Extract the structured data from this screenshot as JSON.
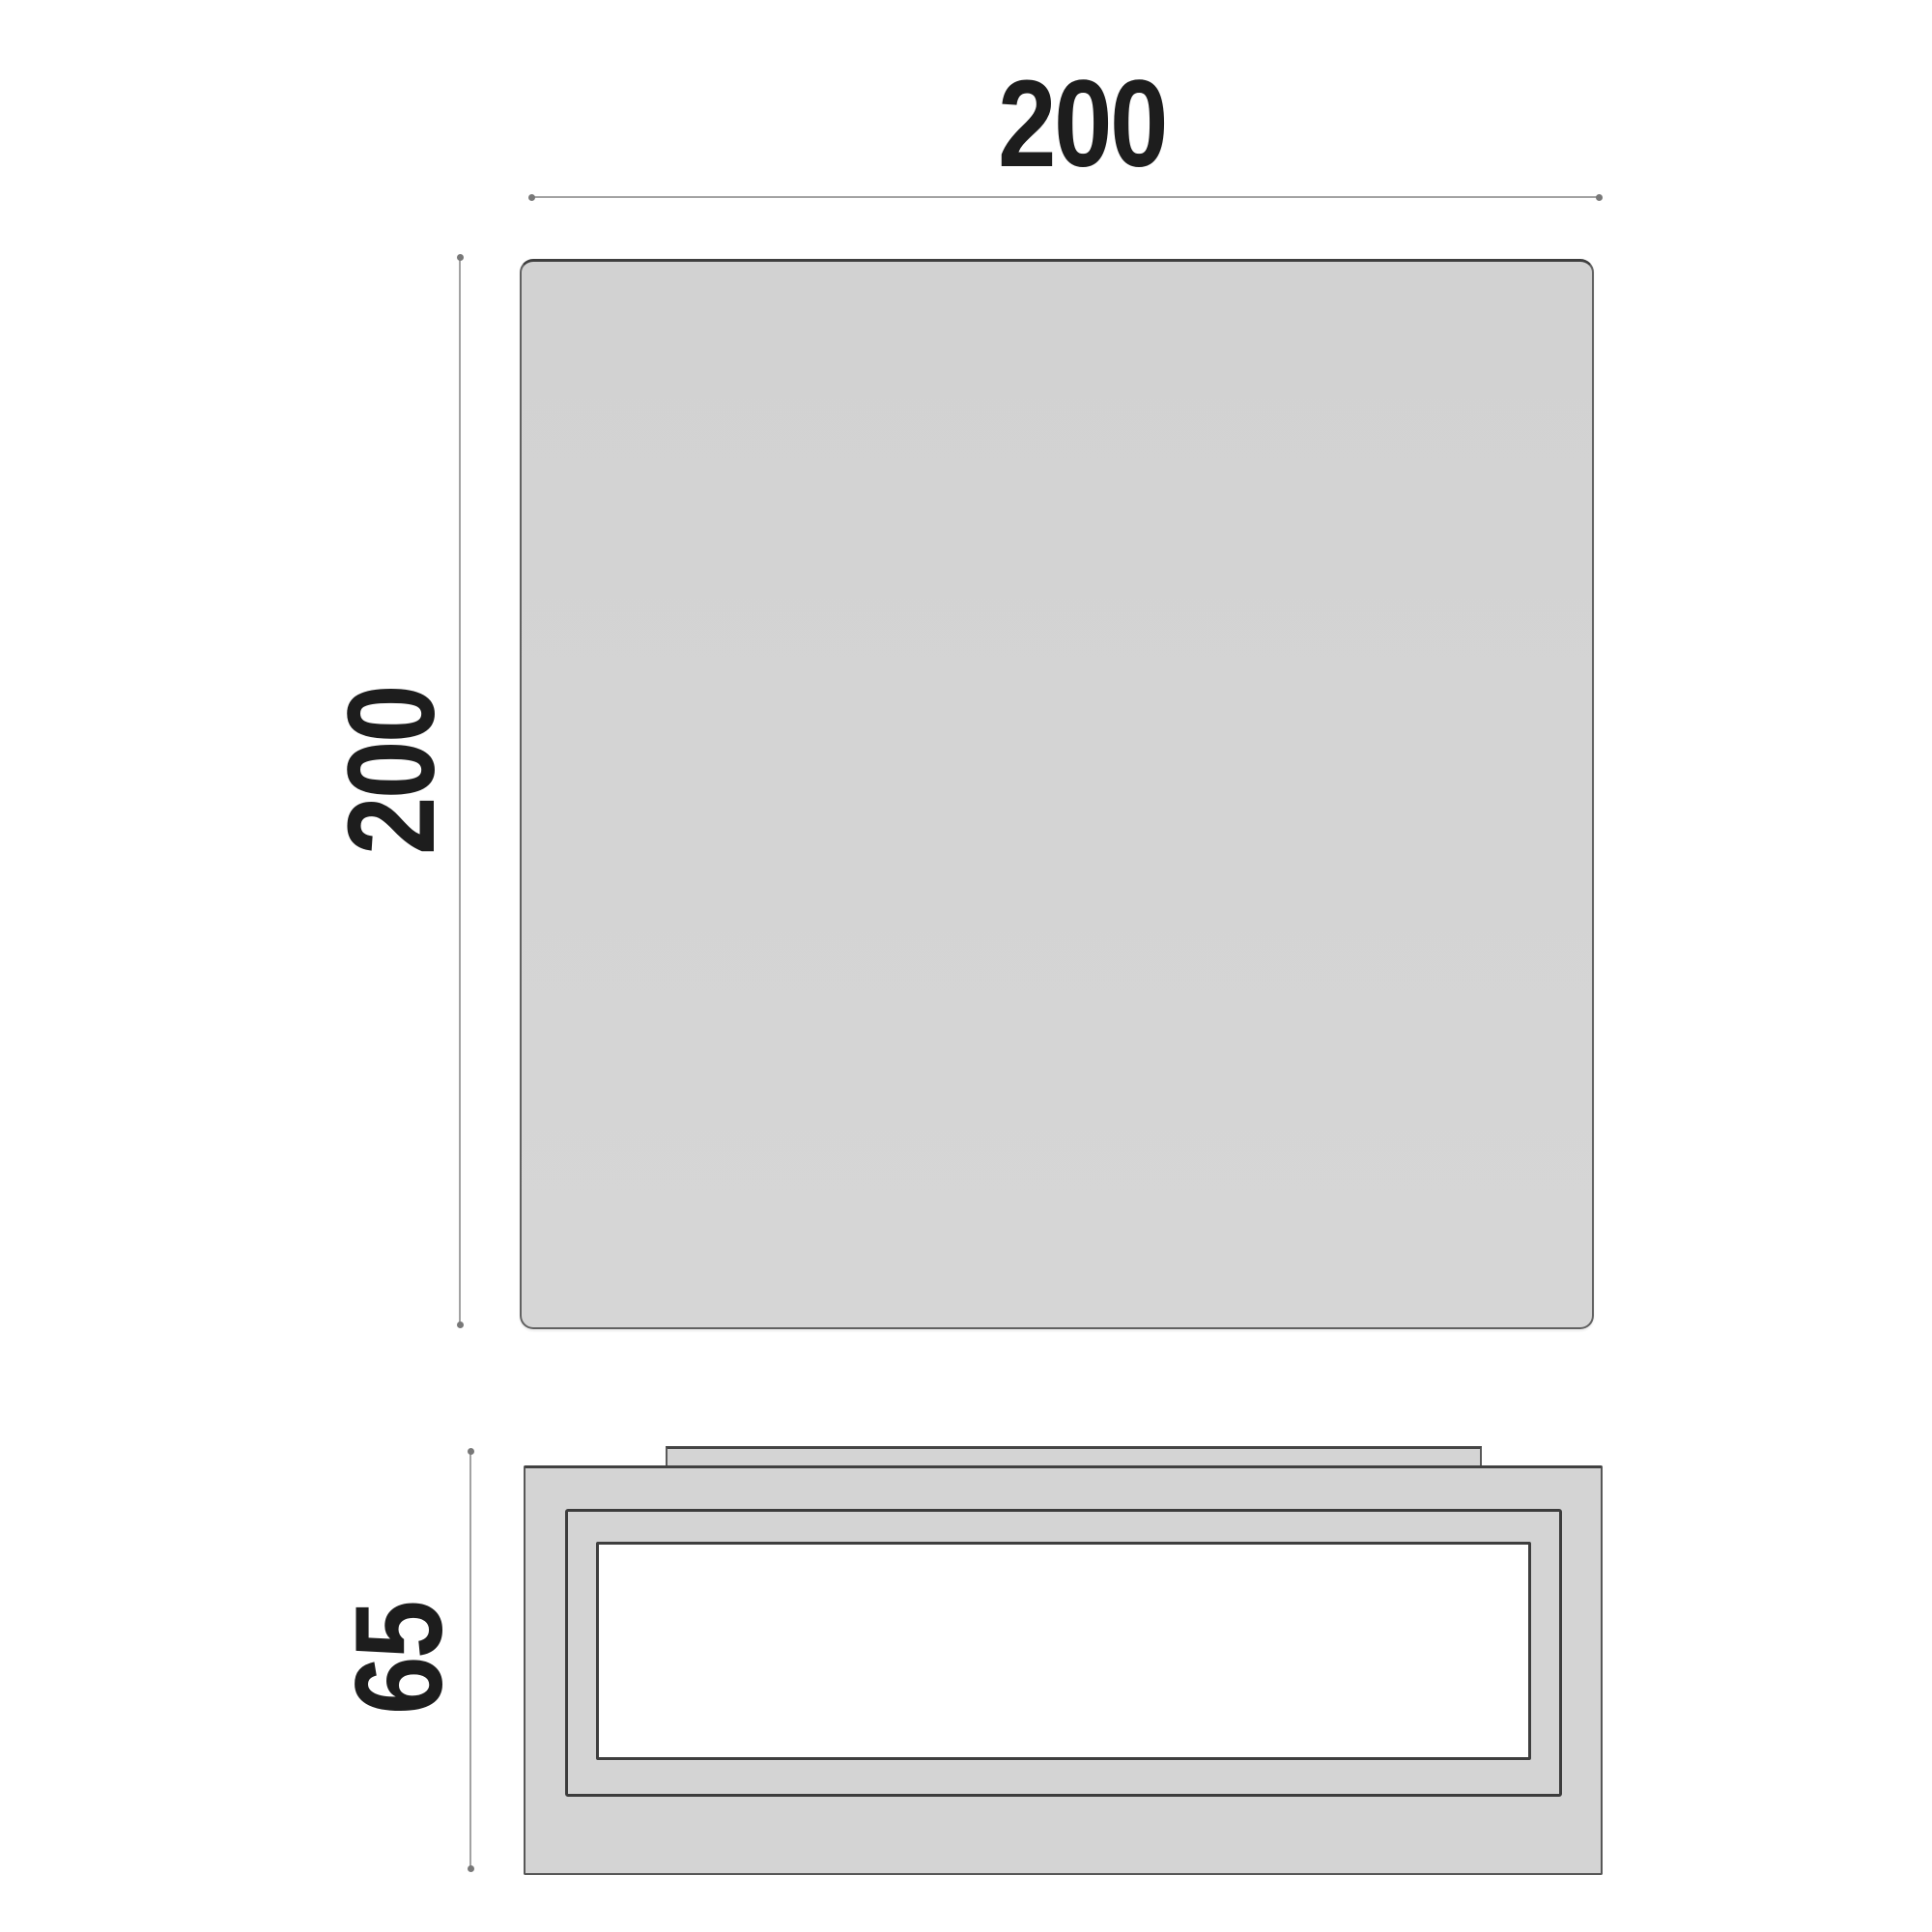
{
  "drawing": {
    "dimensions": {
      "width": {
        "value": "200"
      },
      "height": {
        "value": "200"
      },
      "depth": {
        "value": "65"
      }
    },
    "colors": {
      "background": "#ffffff",
      "panel_fill": "#d4d4d4",
      "panel_outline": "#5e5e5e",
      "frame_outline": "#3c3c3c",
      "diffuser_fill": "#ffffff",
      "dimension_line": "#a2a2a2",
      "dimension_tick": "#787878",
      "label_text": "#1d1d1d"
    }
  }
}
